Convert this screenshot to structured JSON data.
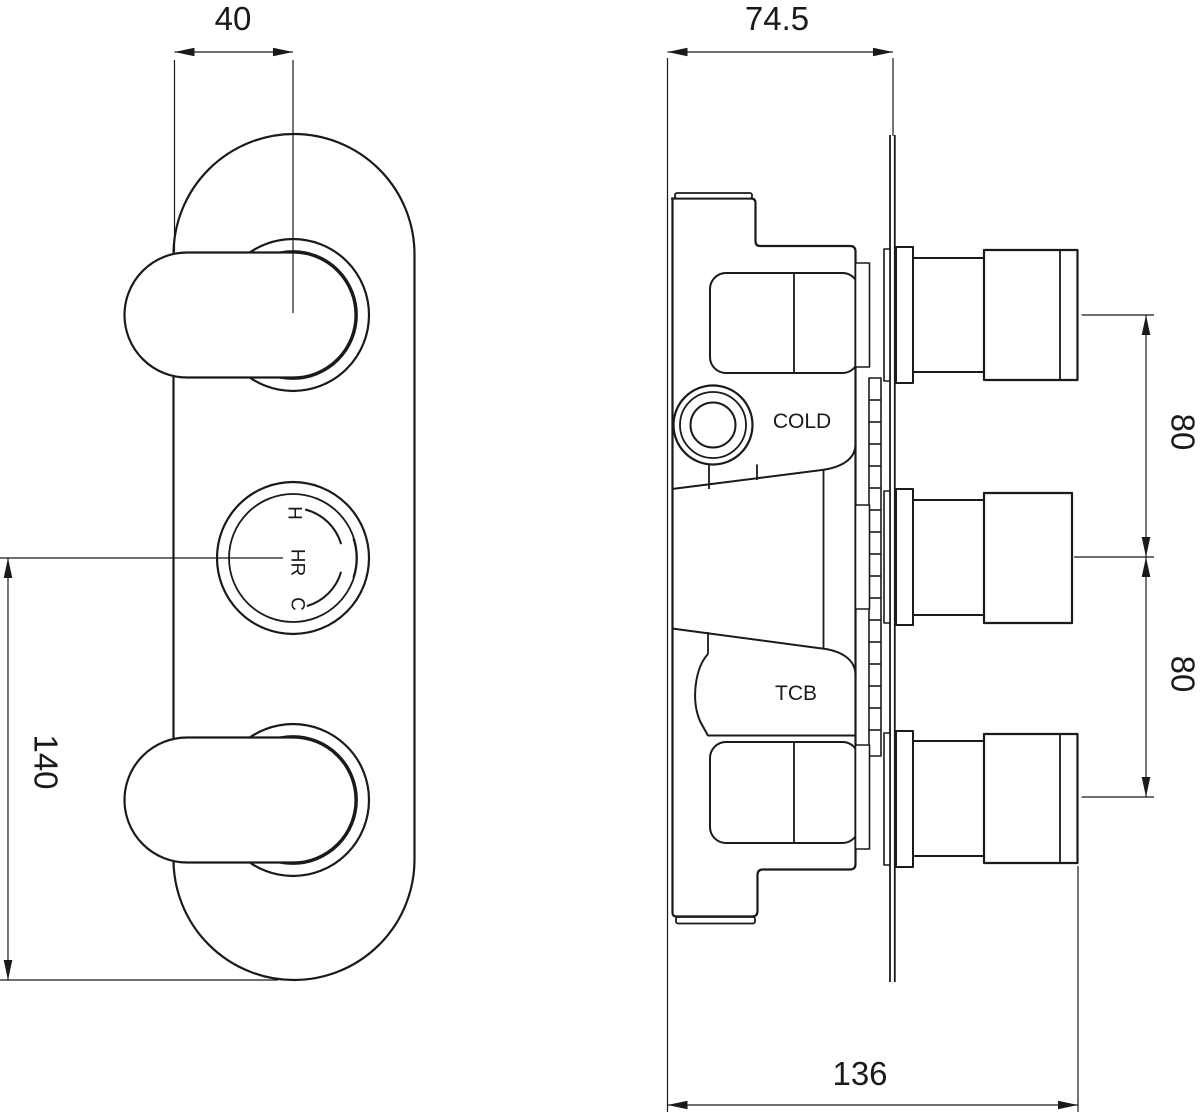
{
  "drawing": {
    "type": "technical-orthographic-drawing",
    "subject": "triple concealed shower valve",
    "line_color": "#1a1a1a",
    "background": "#ffffff",
    "dimensions": {
      "handle_offset": "40",
      "body_depth": "74.5",
      "spacing_top": "80",
      "spacing_bottom": "80",
      "faceplate_length": "140",
      "total_depth": "136"
    },
    "labels": {
      "cold_port": "COLD",
      "tcb_port": "TCB",
      "dial_hot": "H",
      "dial_mid": "HR",
      "dial_cold": "C"
    }
  }
}
